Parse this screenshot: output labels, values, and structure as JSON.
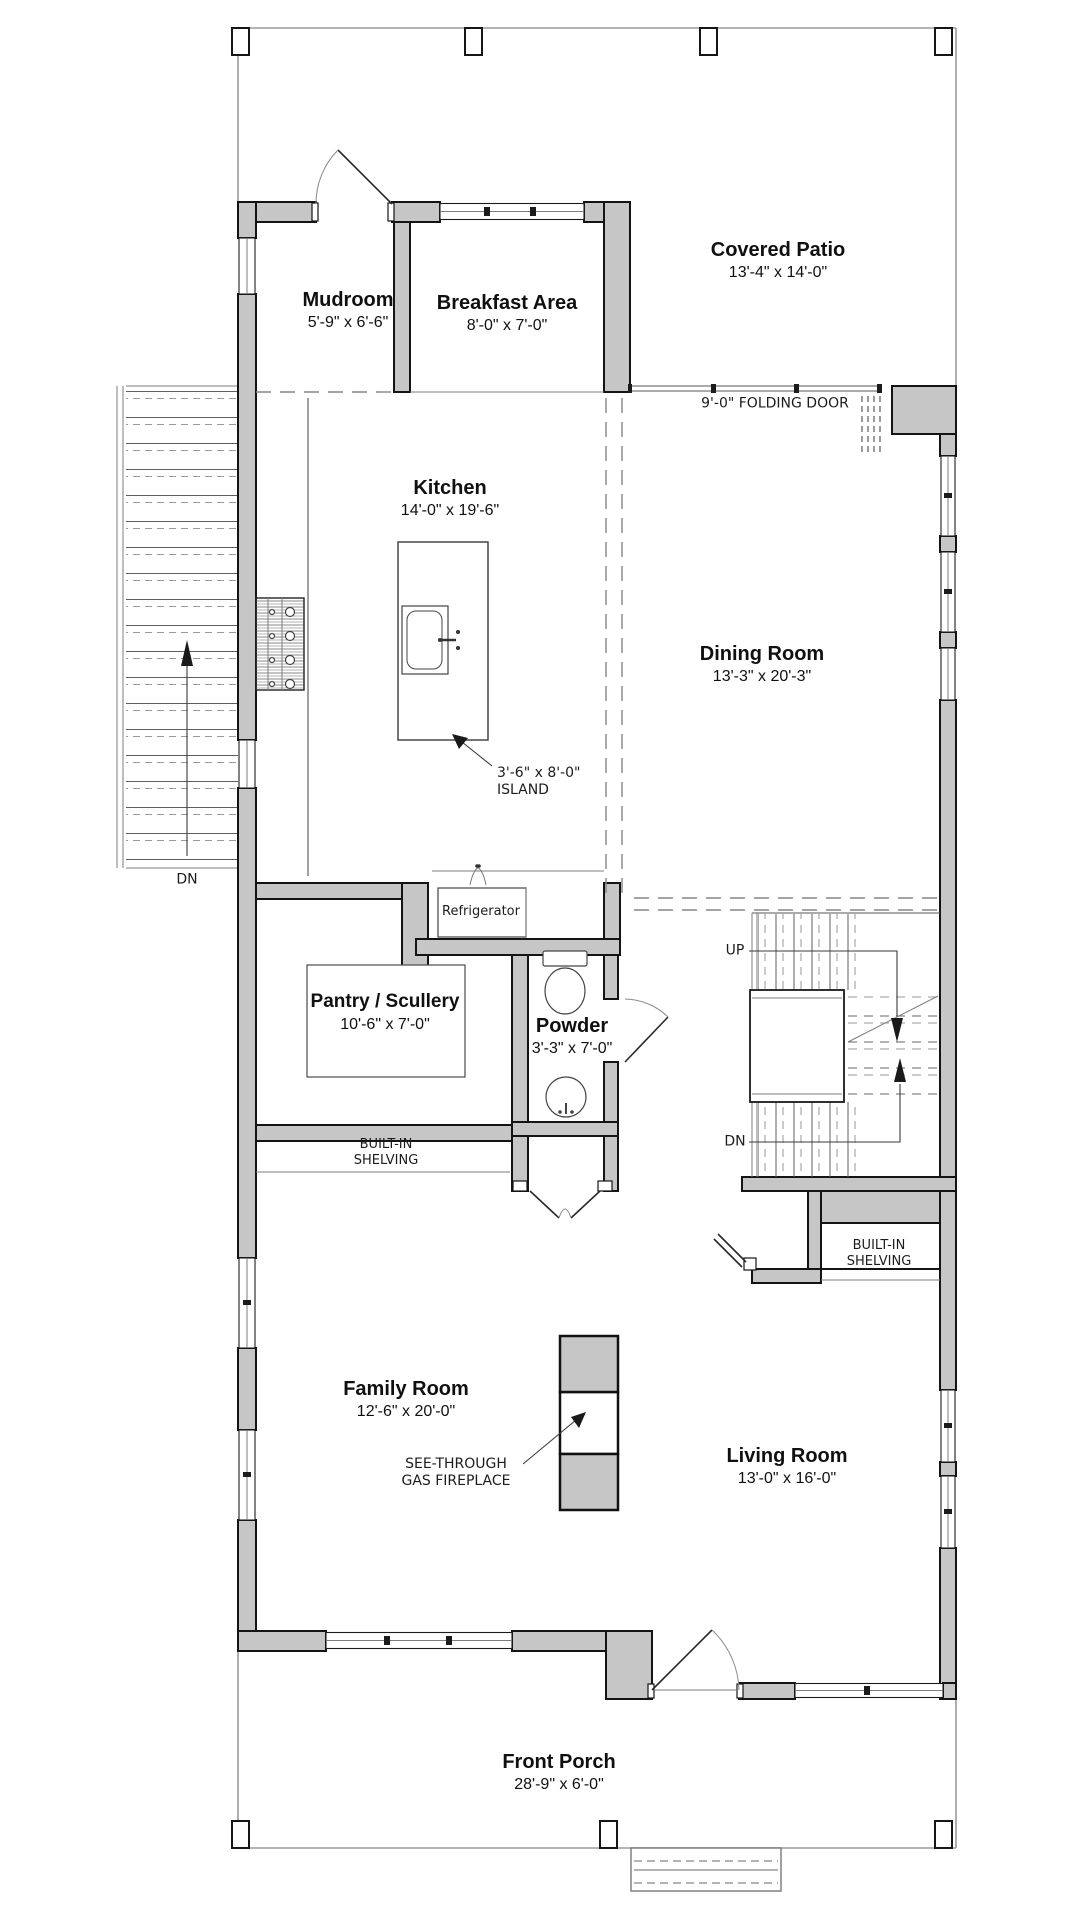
{
  "plan": {
    "rooms": [
      {
        "id": "covered-patio",
        "name": "Covered Patio",
        "dims": "13'-4\" x 14'-0\""
      },
      {
        "id": "mudroom",
        "name": "Mudroom",
        "dims": "5'-9\" x 6'-6\""
      },
      {
        "id": "breakfast",
        "name": "Breakfast Area",
        "dims": "8'-0\" x 7'-0\""
      },
      {
        "id": "kitchen",
        "name": "Kitchen",
        "dims": "14'-0\" x 19'-6\""
      },
      {
        "id": "dining",
        "name": "Dining Room",
        "dims": "13'-3\" x 20'-3\""
      },
      {
        "id": "pantry",
        "name": "Pantry / Scullery",
        "dims": "10'-6\" x 7'-0\""
      },
      {
        "id": "powder",
        "name": "Powder",
        "dims": "3'-3\" x 7'-0\""
      },
      {
        "id": "family",
        "name": "Family Room",
        "dims": "12'-6\" x 20'-0\""
      },
      {
        "id": "living",
        "name": "Living Room",
        "dims": "13'-0\" x 16'-0\""
      },
      {
        "id": "porch",
        "name": "Front Porch",
        "dims": "28'-9\" x 6'-0\""
      }
    ],
    "annotations": {
      "folding_door": "9'-0\" FOLDING DOOR",
      "island": [
        "3'-6\" x 8'-0\"",
        "ISLAND"
      ],
      "refrigerator": "Refrigerator",
      "built_in": [
        "BUILT-IN",
        "SHELVING"
      ],
      "fireplace": [
        "SEE-THROUGH",
        "GAS FIREPLACE"
      ],
      "up": "UP",
      "down": "DN"
    },
    "colors": {
      "wall_fill": "#c6c6c6",
      "boundary": "#9b9b9b",
      "line": "#1a1a1a",
      "background": "#ffffff"
    }
  }
}
